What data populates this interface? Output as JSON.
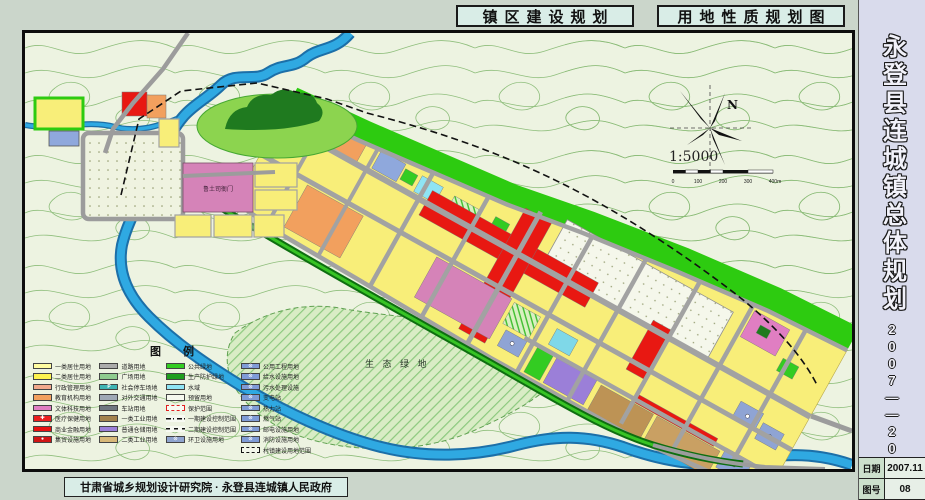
{
  "header": {
    "left_title": "镇区建设规划",
    "right_title": "用地性质规划图"
  },
  "sidebar": {
    "sheet_title": "永登县连城镇总体规划",
    "period": "2007——2020",
    "info_rows": [
      {
        "label": "日期",
        "value": "2007.11"
      },
      {
        "label": "图号",
        "value": "08"
      }
    ]
  },
  "footer": {
    "credit": "甘肃省城乡规划设计研究院 · 永登县连城镇人民政府"
  },
  "map": {
    "labels": {
      "historic_site": "鲁土司衙门",
      "eco_green": "生 态 绿 地"
    },
    "compass": {
      "north": "N"
    },
    "scale": {
      "ratio": "1:5000",
      "ticks": [
        "0",
        "100",
        "200",
        "300",
        "400m"
      ]
    }
  },
  "colors": {
    "residential_1": "#FFFCA0",
    "residential_2": "#FDF34F",
    "commercial_red": "#E81812",
    "culture_pink": "#D583B8",
    "education_orange": "#F2A05E",
    "storage_purple": "#9B7FD8",
    "industry_tan": "#C9A063",
    "water_blue": "#2FA9E2",
    "green_space": "#2DCB10",
    "road_gray": "#A2A2A2"
  },
  "legend": {
    "title": "图　　例",
    "columns": [
      {
        "entries": [
          {
            "label": "一类居住用地",
            "color": "#FFFCA0",
            "sym": ""
          },
          {
            "label": "二类居住用地",
            "color": "#FDF34F",
            "sym": ""
          },
          {
            "label": "行政管理用地",
            "color": "#F2A98C",
            "sym": ""
          },
          {
            "label": "教育机构用地",
            "color": "#F2A05E",
            "sym": ""
          },
          {
            "label": "文体科技用地",
            "color": "#E07EC2",
            "sym": ""
          },
          {
            "label": "医疗保健用地",
            "color": "#EA1F1F",
            "sym": "✚"
          },
          {
            "label": "商业金融用地",
            "color": "#E81111",
            "sym": ""
          },
          {
            "label": "集贸设施用地",
            "color": "#D01515",
            "sym": "●"
          }
        ]
      },
      {
        "entries": [
          {
            "label": "道路用地",
            "color": "#ABABAB",
            "sym": ""
          },
          {
            "label": "广场用地",
            "color": "#8FCC8F",
            "sym": ""
          },
          {
            "label": "社会停车场地",
            "color": "#3FB4B4",
            "sym": "P"
          },
          {
            "label": "对外交通用地",
            "color": "#9FA8B5",
            "sym": ""
          },
          {
            "label": "车站用地",
            "color": "#6F7780",
            "sym": ""
          },
          {
            "label": "一类工业用地",
            "color": "#A3824E",
            "sym": ""
          },
          {
            "label": "普通仓储用地",
            "color": "#9B7FD8",
            "sym": ""
          },
          {
            "label": "二类工业用地",
            "color": "#D8B878",
            "sym": ""
          }
        ]
      },
      {
        "entries": [
          {
            "label": "公共绿地",
            "color": "#33CC22",
            "sym": ""
          },
          {
            "label": "生产防护绿地",
            "color": "#1F9E1F",
            "sym": ""
          },
          {
            "label": "水域",
            "color": "#8FE4F4",
            "sym": ""
          },
          {
            "label": "预留用地",
            "cls": "pale",
            "sym": ""
          },
          {
            "label": "保护范围",
            "cls": "dashred",
            "sym": ""
          },
          {
            "label": "一期建设控制范围",
            "cls": "ln1",
            "sym": ""
          },
          {
            "label": "二期建设控制范围",
            "cls": "ln2",
            "sym": ""
          },
          {
            "label": "环卫设施用地",
            "color": "#8FA4CF",
            "sym": "⊙"
          }
        ]
      },
      {
        "entries": [
          {
            "label": "公用工程用地",
            "color": "#7F9BD6",
            "sym": "⊙"
          },
          {
            "label": "给水设施用地",
            "color": "#7F9BD6",
            "sym": "⊙"
          },
          {
            "label": "污水处理设施",
            "color": "#7F9BD6",
            "sym": "⊙"
          },
          {
            "label": "变电站",
            "color": "#7F9BD6",
            "sym": "⊙"
          },
          {
            "label": "热力站",
            "color": "#7F9BD6",
            "sym": "⊙"
          },
          {
            "label": "燃气站",
            "color": "#7F9BD6",
            "sym": "⊙"
          },
          {
            "label": "邮电设施用地",
            "color": "#7F9BD6",
            "sym": "⊙"
          },
          {
            "label": "消防设施用地",
            "color": "#7F9BD6",
            "sym": "⊙"
          },
          {
            "label": "村镇建设用地范围",
            "cls": "dashblk",
            "sym": ""
          }
        ]
      }
    ]
  }
}
